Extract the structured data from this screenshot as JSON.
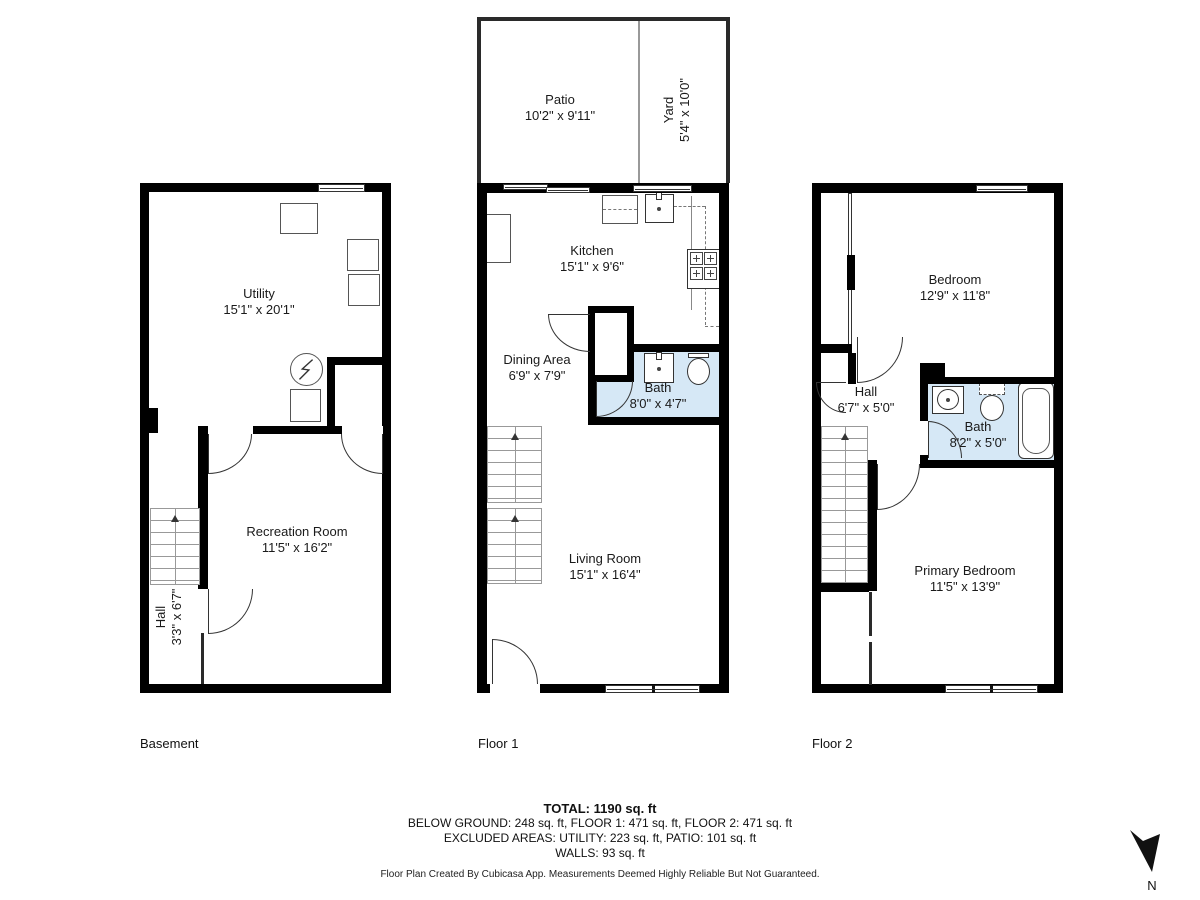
{
  "colors": {
    "wall": "#000000",
    "bath_fill": "#d6e8f6",
    "accent_line": "#444444"
  },
  "compass": {
    "label": "N"
  },
  "floors": [
    {
      "label": "Basement",
      "rooms": [
        {
          "name": "Utility",
          "dims": "15'1\" x 20'1\""
        },
        {
          "name": "Recreation Room",
          "dims": "11'5\" x 16'2\""
        },
        {
          "name": "Hall",
          "dims": "3'3\" x 6'7\""
        }
      ]
    },
    {
      "label": "Floor 1",
      "rooms": [
        {
          "name": "Patio",
          "dims": "10'2\" x 9'11\""
        },
        {
          "name": "Yard",
          "dims": "5'4\" x 10'0\""
        },
        {
          "name": "Kitchen",
          "dims": "15'1\" x 9'6\""
        },
        {
          "name": "Dining Area",
          "dims": "6'9\" x 7'9\""
        },
        {
          "name": "Bath",
          "dims": "8'0\" x 4'7\""
        },
        {
          "name": "Living Room",
          "dims": "15'1\" x 16'4\""
        }
      ]
    },
    {
      "label": "Floor 2",
      "rooms": [
        {
          "name": "Bedroom",
          "dims": "12'9\" x 11'8\""
        },
        {
          "name": "Hall",
          "dims": "6'7\" x 5'0\""
        },
        {
          "name": "Bath",
          "dims": "8'2\" x 5'0\""
        },
        {
          "name": "Primary Bedroom",
          "dims": "11'5\" x 13'9\""
        }
      ]
    }
  ],
  "summary": {
    "total": "TOTAL: 1190 sq. ft",
    "by_floor": "BELOW GROUND: 248 sq. ft, FLOOR 1: 471 sq. ft, FLOOR 2: 471 sq. ft",
    "excluded": "EXCLUDED AREAS: UTILITY: 223 sq. ft, PATIO: 101 sq. ft",
    "walls": "WALLS: 93 sq. ft",
    "disclaimer": "Floor Plan Created By Cubicasa App. Measurements Deemed Highly Reliable But Not Guaranteed."
  }
}
